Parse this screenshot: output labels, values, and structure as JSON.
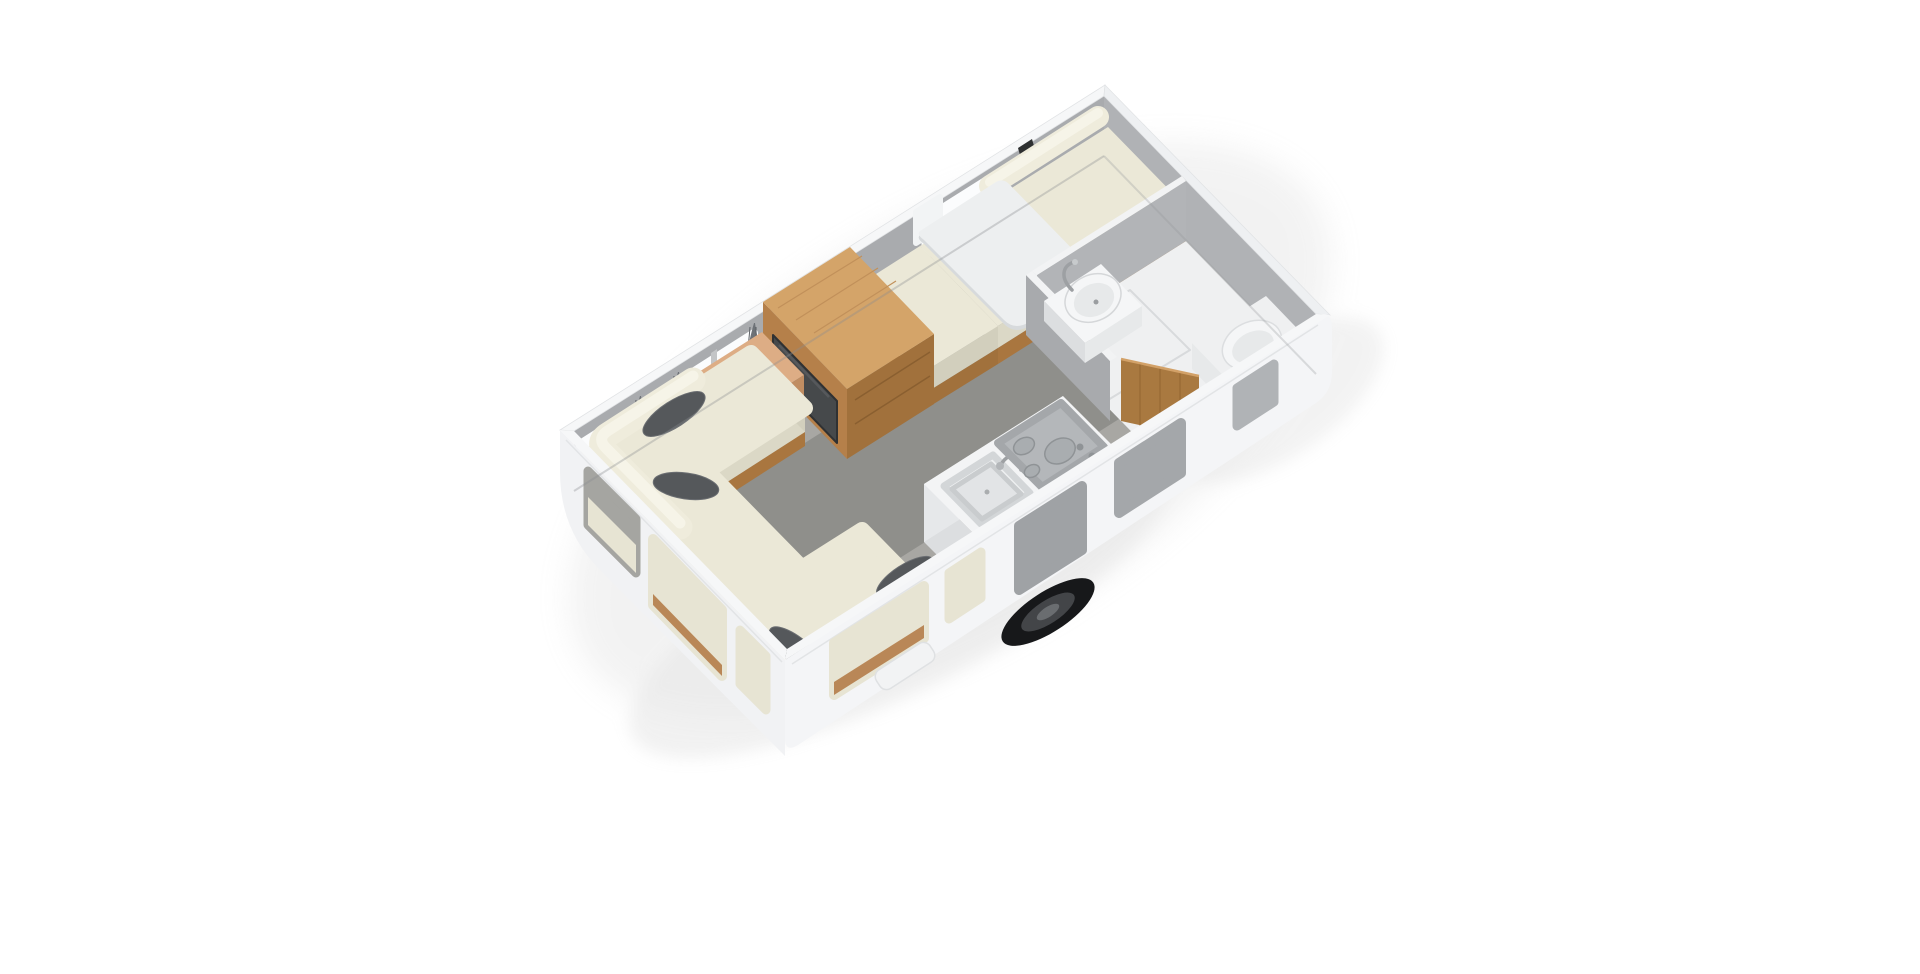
{
  "page": {
    "width": 1920,
    "height": 974,
    "background": "#ffffff"
  },
  "scene": {
    "type": "3d-isometric-caravan-floor-plan-render",
    "items": [
      {
        "name": "lounge-sofa-u-shape"
      },
      {
        "name": "scatter-cushions",
        "count": 5
      },
      {
        "name": "window-curtains",
        "count": 3
      },
      {
        "name": "sideboard"
      },
      {
        "name": "wardrobe-with-appliance-panel"
      },
      {
        "name": "dinette-bench-small"
      },
      {
        "name": "dinette-bench-long"
      },
      {
        "name": "dinette-table"
      },
      {
        "name": "kitchen-counter-sink-hob"
      },
      {
        "name": "bathroom-washbasin"
      },
      {
        "name": "bathroom-toilet"
      },
      {
        "name": "bathroom-shower-floor"
      },
      {
        "name": "bathroom-wooden-door"
      },
      {
        "name": "entry-door-opening"
      },
      {
        "name": "wheel"
      },
      {
        "name": "entry-step"
      }
    ]
  },
  "colors": {
    "background": "#ffffff",
    "shadow": "#b9b9b9",
    "wall_top_left": "#a9abae",
    "wall_rear": "#b0b2b5",
    "wall_cap": "#f6f7f8",
    "wall_cap_rear": "#eef0f2",
    "band_outer": "#f4f5f7",
    "band_front": "#f1f2f4",
    "floor_main": "#a8a7a3",
    "floor_walkway": "#8f8f8b",
    "floor_shadow": "#6e6d6b",
    "bathroom_floor": "#eff0f1",
    "partition_a": "#a8aaad",
    "partition_b": "#b2b4b7",
    "partition_cap": "#f2f3f4",
    "cream_top": "#ebe8d7",
    "cream_side": "#dbd8c6",
    "cream_side_dark": "#d2cfbd",
    "cream_back": "#efecdc",
    "cream_back_hi": "#f6f4e8",
    "wood_base": "#a9763f",
    "wood_top": "#d4a469",
    "wood_front": "#b5804a",
    "wood_side": "#a1713c",
    "sideboard_top": "#ddad85",
    "sideboard_front": "#c08d62",
    "sideboard_side": "#b07c50",
    "door_wood": "#a97940",
    "panel_dark": "#46494b",
    "table_top": "#edeff0",
    "table_edge": "#d7dadc",
    "counter_top": "#f3f4f5",
    "counter_front": "#e6e8ea",
    "counter_side": "#dcdee0",
    "sink_outer": "#eef0f1",
    "sink_basin": "#e2e4e6",
    "stove_panel": "#b4b7ba",
    "burner": "#a9adb0",
    "burner_ring": "#8f9396",
    "chrome": "#9da0a3",
    "fixture_white": "#f5f6f7",
    "fixture_shade": "#e7e9ea",
    "window_white": "#fbfcfd",
    "window_cream": "#e7e4d3",
    "window_gray": "#a4a7aa",
    "window_gray_dark": "#9fa2a5",
    "window_wood": "#b98757",
    "window_top_gray": "#a5a5a1",
    "curtain": "#6e7277",
    "curtain_tie": "#d2a62f",
    "pillow": "#55585b",
    "tire": "#17181a",
    "rim": "#434548",
    "hub": "#6a6d70",
    "notch_dark": "#2e3031",
    "mullion": "#c3c5c7",
    "step": "#f2f3f4"
  }
}
